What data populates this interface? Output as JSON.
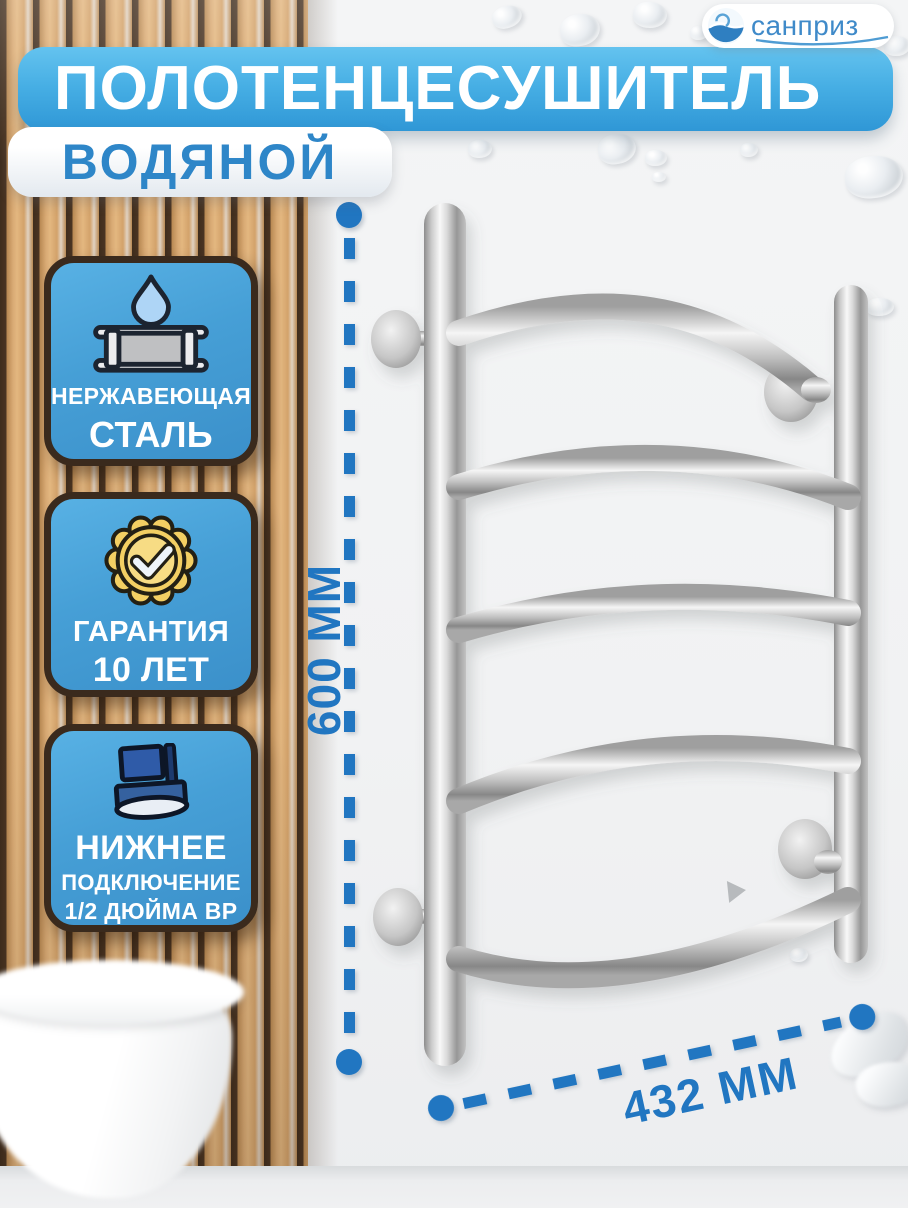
{
  "brand": {
    "name": "санприз"
  },
  "header": {
    "title": "ПОЛОТЕНЦЕСУШИТЕЛЬ",
    "subtitle": "ВОДЯНОЙ"
  },
  "features": [
    {
      "icon": "stainless-steel-pipe-icon",
      "line1": "НЕРЖАВЕЮЩАЯ",
      "line2": "СТАЛЬ"
    },
    {
      "icon": "warranty-seal-icon",
      "line1": "ГАРАНТИЯ",
      "line2": "10 ЛЕТ"
    },
    {
      "icon": "bottom-connection-icon",
      "line1": "НИЖНЕЕ",
      "line2": "ПОДКЛЮЧЕНИЕ",
      "line3": "1/2 ДЮЙМА ВР"
    }
  ],
  "dimensions": {
    "height": "600 ММ",
    "width": "432 ММ"
  },
  "colors": {
    "accent_blue": "#2176c1",
    "banner_gradient_top": "#60c1ee",
    "banner_gradient_bottom": "#2f97d6",
    "badge_blue": "#48a0d7",
    "badge_border_brown": "#3a2a1d",
    "logo_blue": "#3f8ac9",
    "wood_brown": "#d2a06a"
  }
}
